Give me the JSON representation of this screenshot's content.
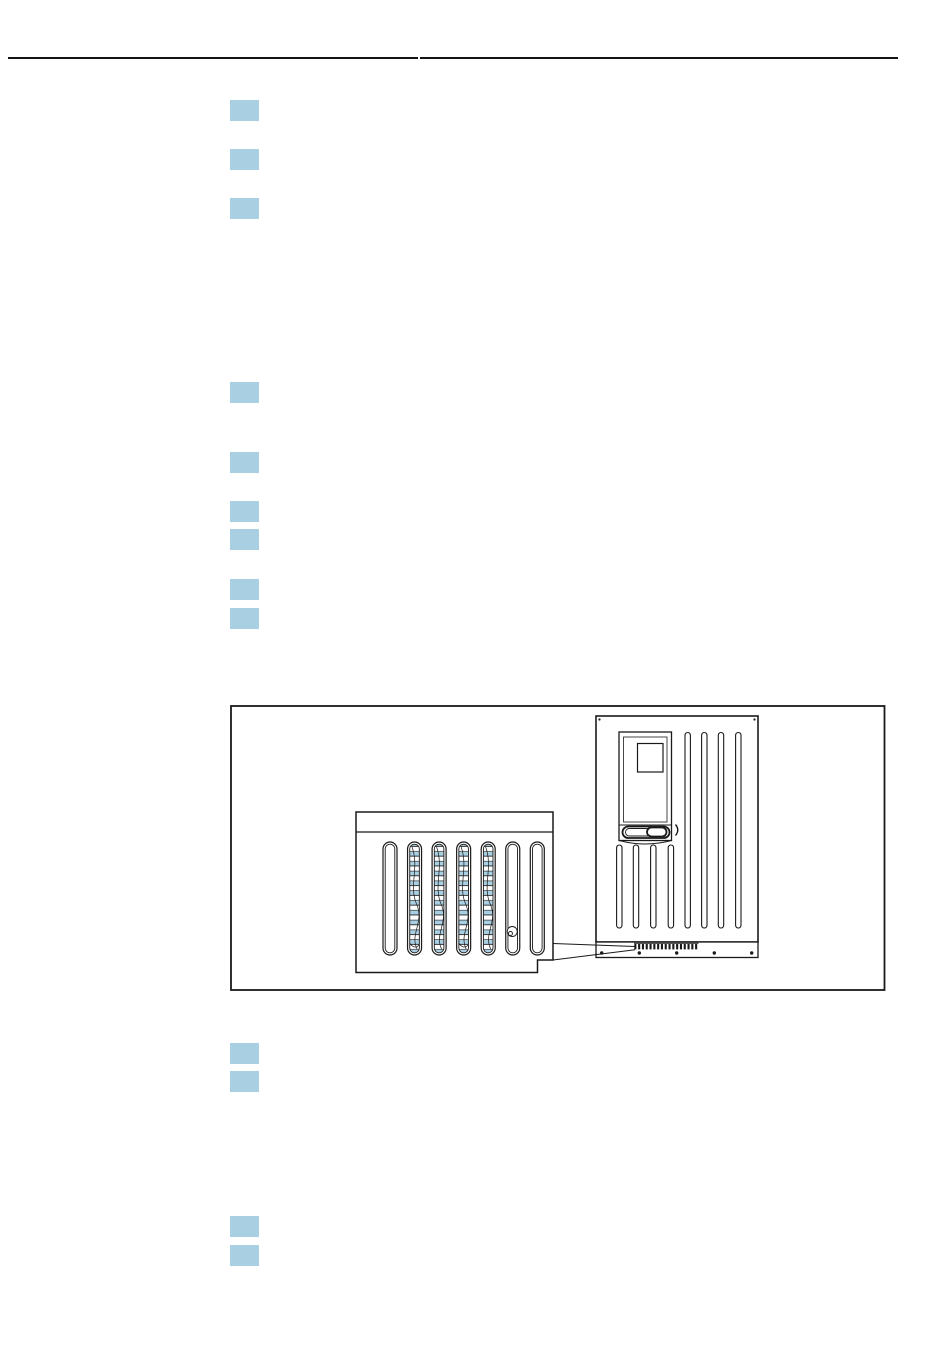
{
  "page": {
    "width": 950,
    "height": 1369,
    "background": "#ffffff"
  },
  "colors": {
    "highlight_blue": "#A9CFE3",
    "line": "#1a1a1a"
  },
  "header": {
    "rule": {
      "left_segment": {
        "x": 8,
        "y": 57,
        "width": 410,
        "height": 2.2
      },
      "right_segment": {
        "x": 419.5,
        "y": 57.3,
        "width": 478,
        "height": 1.9
      }
    }
  },
  "content": {
    "highlight_squares": {
      "x": 230,
      "width": 29,
      "height": 21,
      "tops": [
        100,
        149,
        198,
        382,
        452,
        501,
        529,
        579,
        608,
        1043,
        1071,
        1216,
        1245
      ]
    }
  },
  "figure": {
    "kind": "technical line drawing - analyzer cabinet with magnified fan filter grille inset",
    "border": {
      "x": 231,
      "y": 706,
      "width": 653.5,
      "height": 284
    },
    "analyzer": {
      "right_vent_slats": 4,
      "lower_vent_slats": 4,
      "corner_screws": 2,
      "base_screws": 5,
      "grille_teeth": 17
    },
    "inset": {
      "vent_slots": 7,
      "filter_mat_slots": [
        2,
        3,
        4,
        5
      ],
      "curl_slot": 6
    },
    "leader_lines": 2
  }
}
